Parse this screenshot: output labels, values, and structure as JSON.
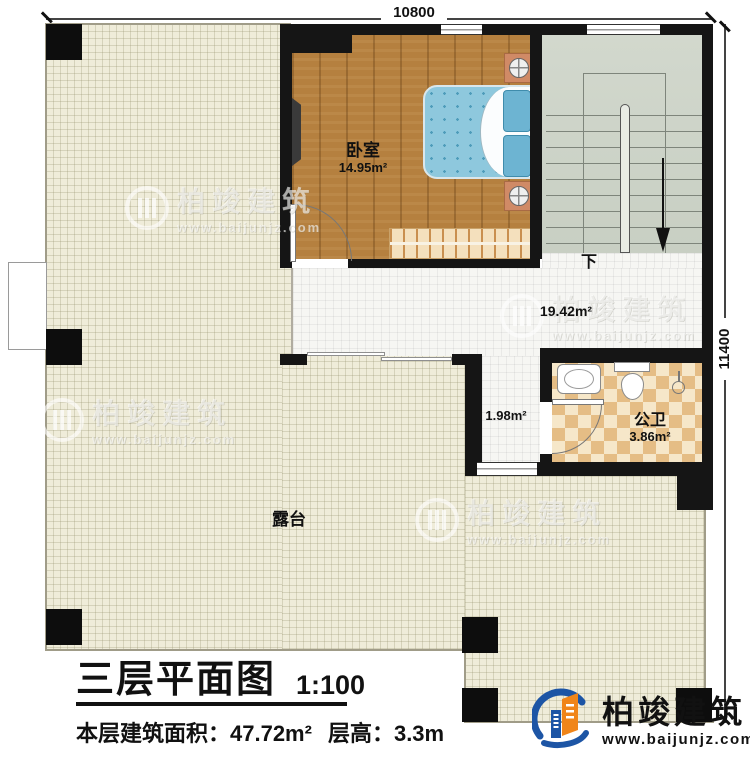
{
  "dimensions": {
    "top": "10800",
    "right": "11400"
  },
  "rooms": {
    "bedroom": {
      "name": "卧室",
      "area": "14.95m²"
    },
    "hall": {
      "area": "19.42m²"
    },
    "stairs_direction": "下",
    "corridor": {
      "area": "1.98m²"
    },
    "bathroom": {
      "name": "公卫",
      "area": "3.86m²"
    },
    "terrace": {
      "name": "露台"
    }
  },
  "title_block": {
    "title": "三层平面图",
    "scale": "1:100",
    "area_text": "本层建筑面积：47.72m²",
    "height_text": "层高：3.3m"
  },
  "branding": {
    "name": "柏竣建筑",
    "url": "www.baijunjz.com"
  },
  "watermark": {
    "name": "柏竣建筑",
    "url": "www.baijunjz.com"
  },
  "colors": {
    "wall": "#151515",
    "wood": "#b5803f",
    "terrace": "#efecd9",
    "stairs": "#ced4c9",
    "tile": "#f6f6f3",
    "checker_dark": "#e5bd85",
    "checker_light": "#f6e7c9",
    "bed": "#8ec8dd",
    "logo_blue": "#1d55a5",
    "logo_orange": "#f08519"
  }
}
